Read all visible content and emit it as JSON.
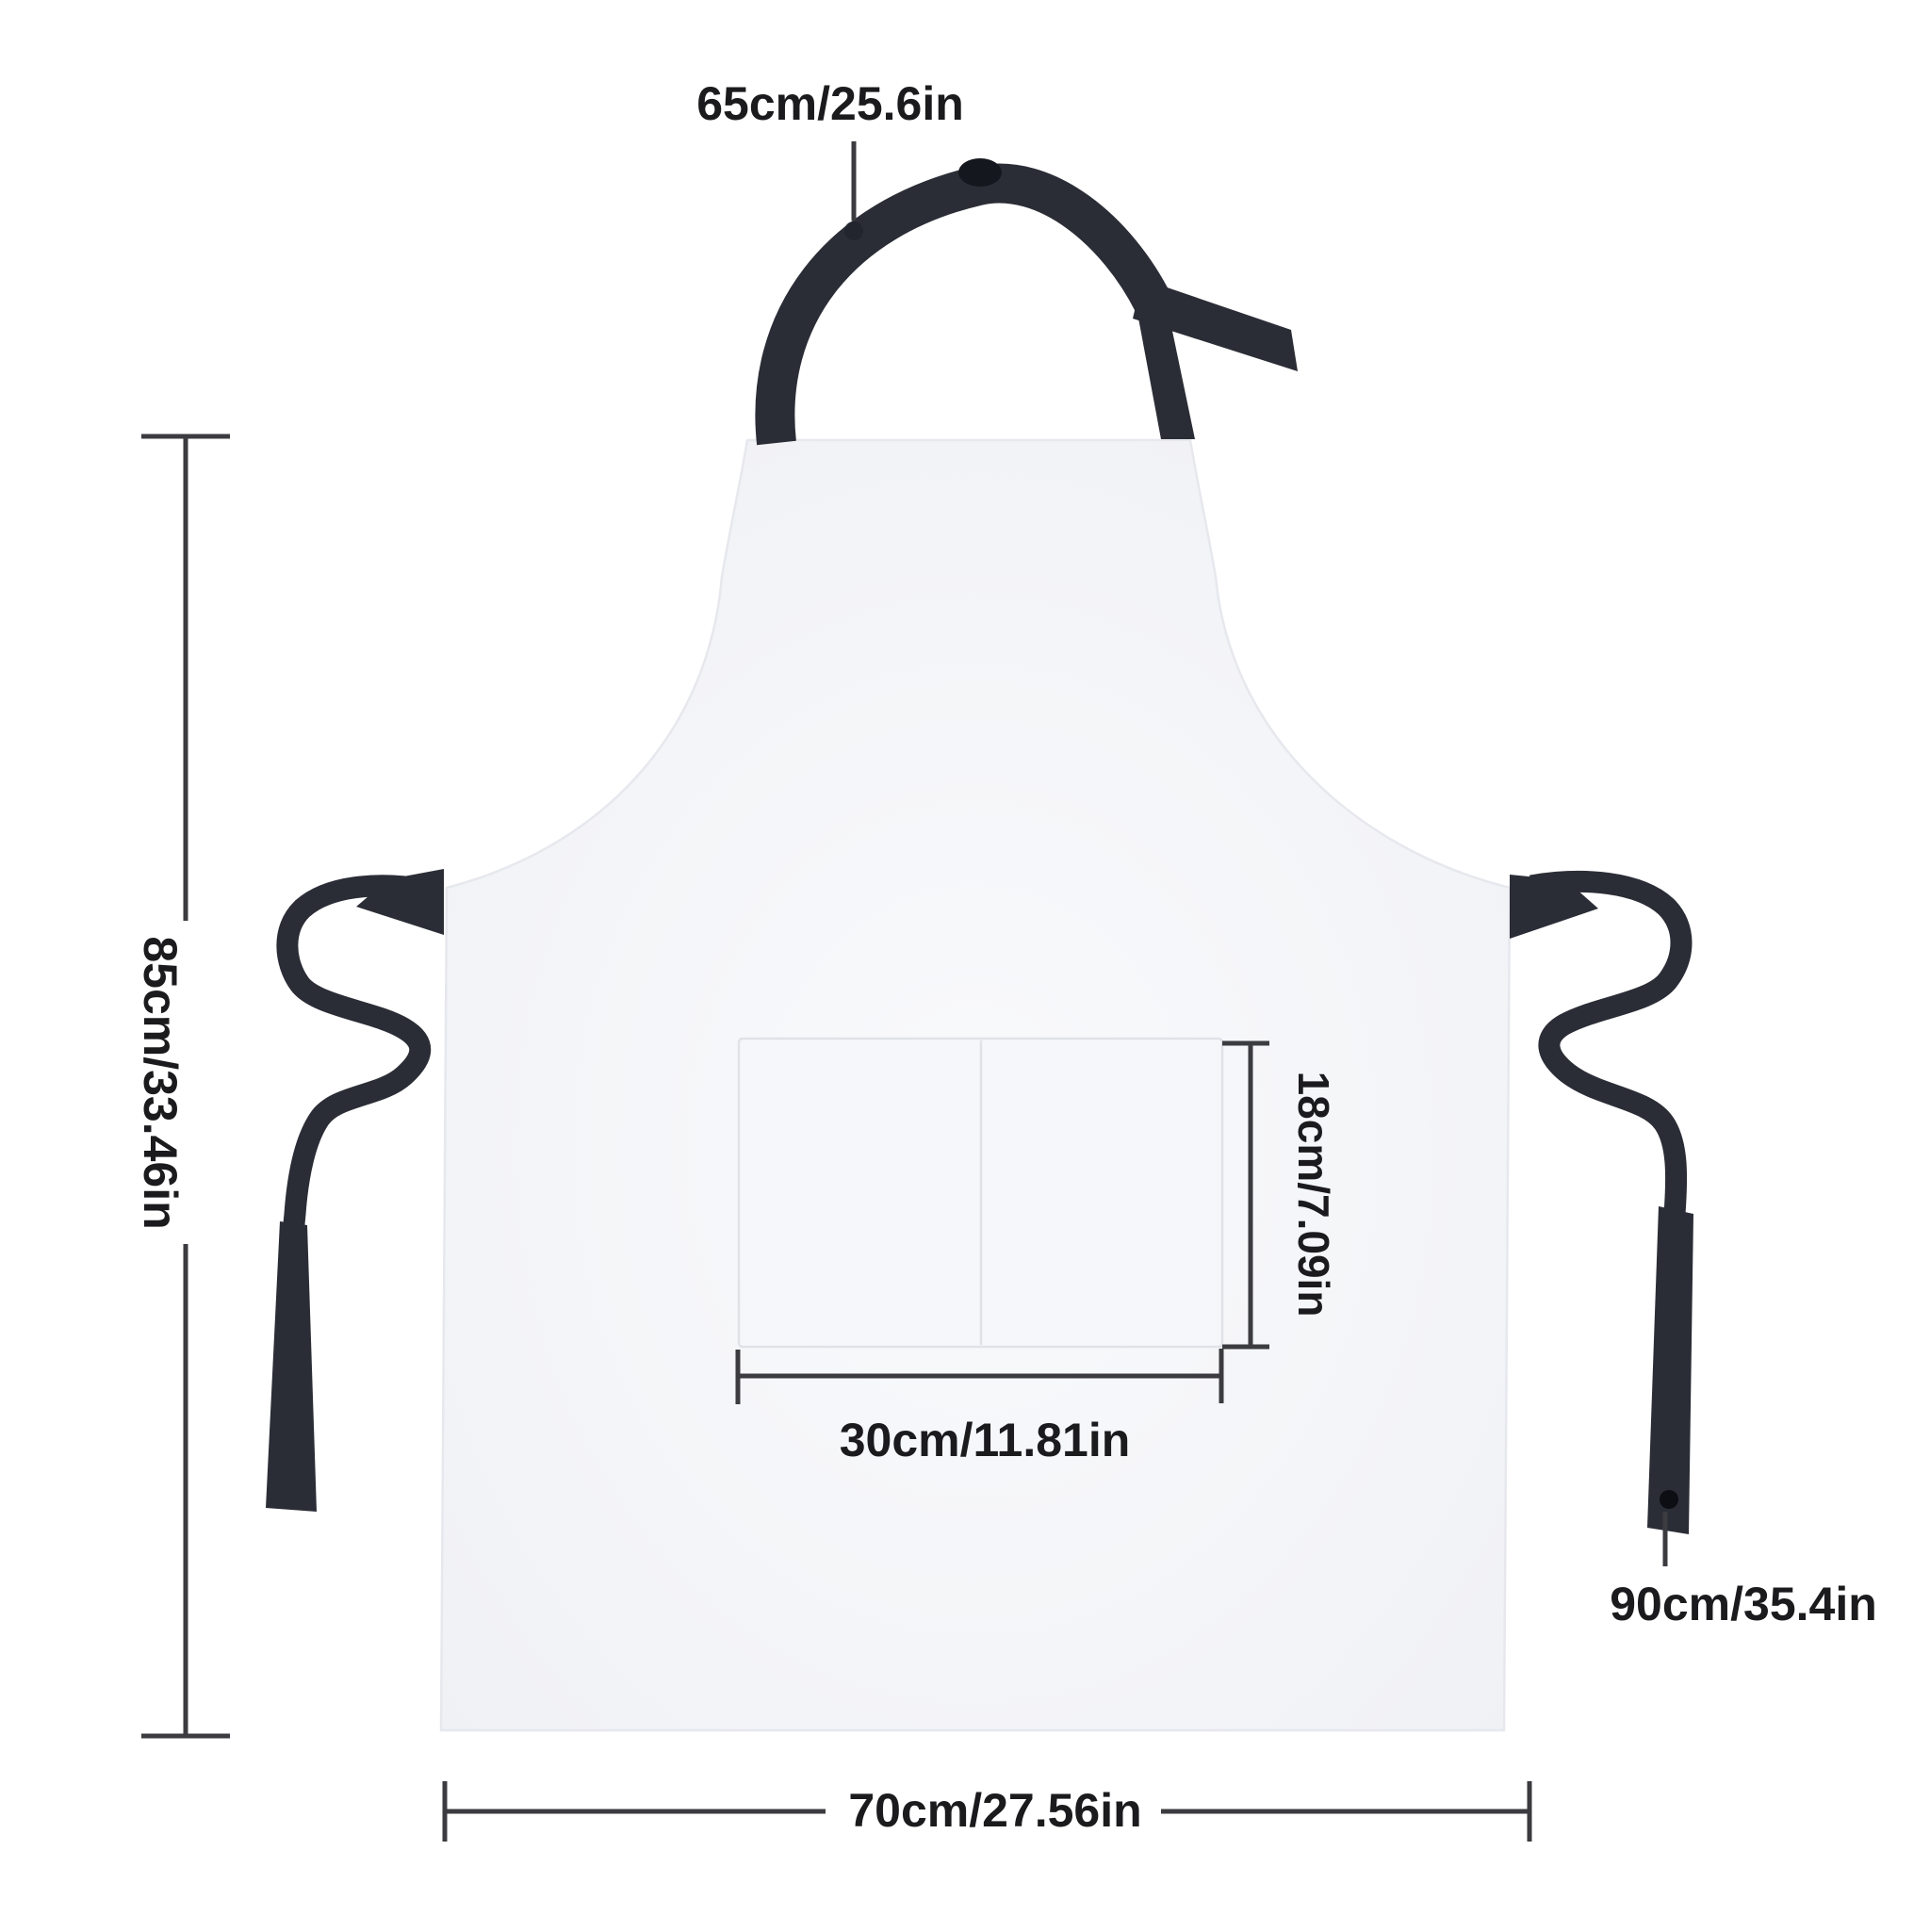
{
  "diagram": {
    "measurements": {
      "neck_strap": {
        "label": "65cm/25.6in"
      },
      "body_height": {
        "label": "85cm/33.46in"
      },
      "pocket_height": {
        "label": "18cm/7.09in"
      },
      "pocket_width": {
        "label": "30cm/11.81in"
      },
      "body_width": {
        "label": "70cm/27.56in"
      },
      "waist_tie": {
        "label": "90cm/35.4in"
      }
    },
    "colors": {
      "background": "#ffffff",
      "apron": "#f3f4f7",
      "apron_edge": "#e7e8ee",
      "pocket": "#f6f7fa",
      "pocket_edge": "#e0e2e9",
      "strap": "#2b2d36",
      "strap_dark": "#15171e",
      "dimension": "#3b3b40",
      "text": "#1b1b1e"
    }
  }
}
